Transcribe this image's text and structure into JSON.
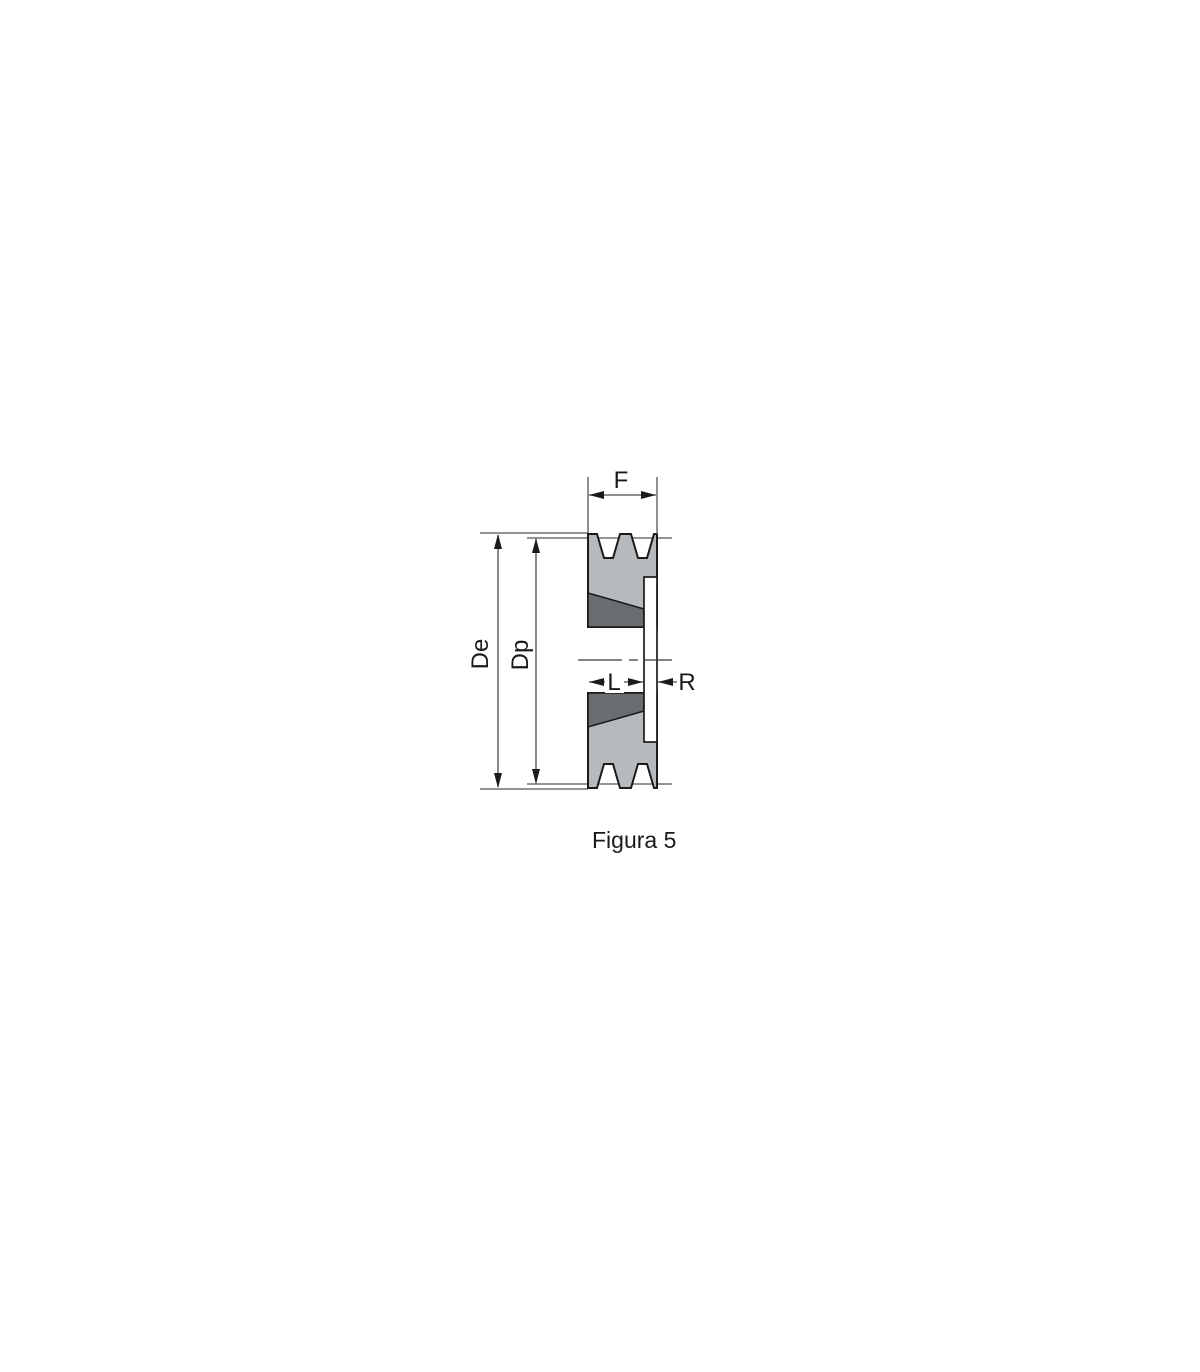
{
  "figure": {
    "caption": "Figura 5",
    "labels": {
      "face_width": "F",
      "external_diameter": "De",
      "pitch_diameter": "Dp",
      "hub_length": "L",
      "flange_width": "R"
    }
  },
  "colors": {
    "background": "#ffffff",
    "pulley_body_fill": "#b7babc",
    "taper_bushing_fill": "#696d70",
    "flange_fill": "#ffffff",
    "outline": "#1b1b1b",
    "dimension_line": "#4a4a4a",
    "text": "#1a1a1a"
  }
}
